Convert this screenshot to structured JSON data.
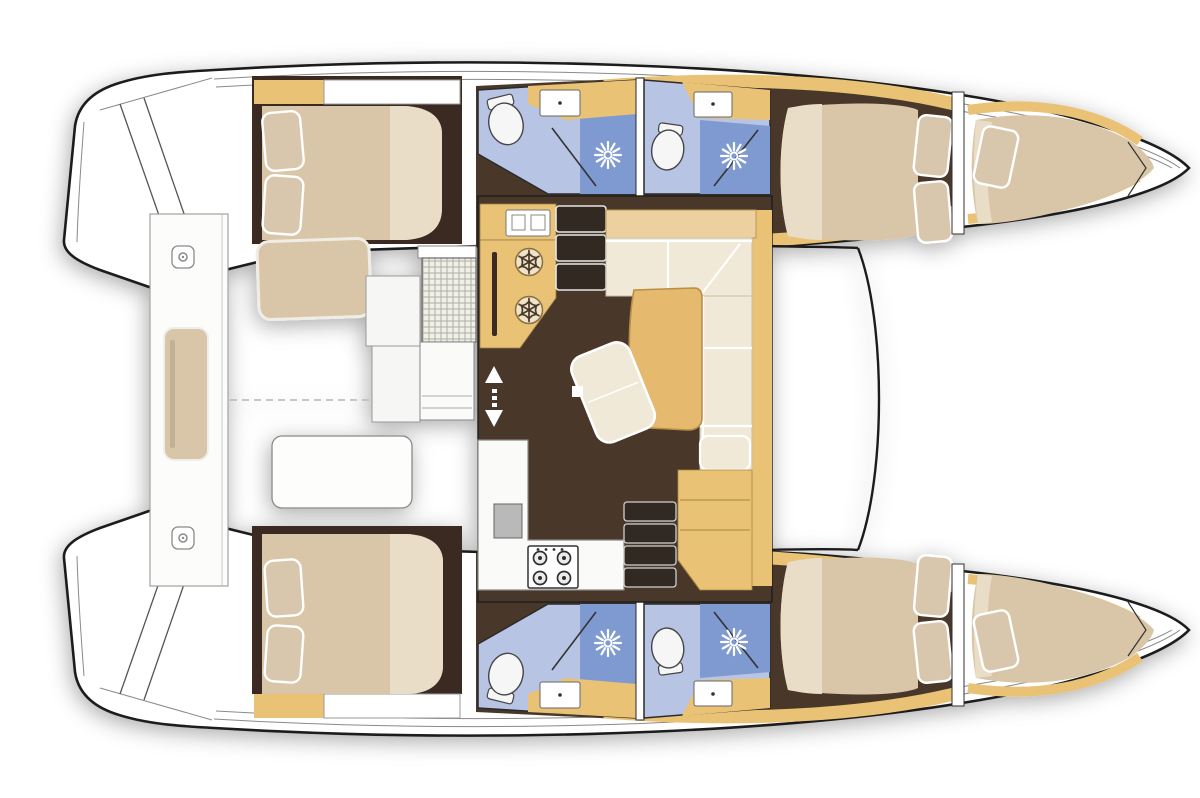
{
  "meta": {
    "label": "Catamaran yacht interior layout - top-down floor plan, bow to the right"
  },
  "palette": {
    "outline": "#1c1c1c",
    "deck_line": "#8a8a8a",
    "hull": "#ffffff",
    "wood": "#e9c276",
    "wood_light": "#ecd0a0",
    "wood_dark": "#b98e44",
    "table": "#e5b96e",
    "floor": "#4a392c",
    "floor_dark": "#3a2c21",
    "mattress": "#d9c6a8",
    "mattress_light": "#e9ddc7",
    "pillow": "#d8c6ad",
    "cushion": "#f1e9d7",
    "bath": "#b7c4e4",
    "bath_mid": "#98acd8",
    "shower": "#7e9ad1",
    "fixture": "#f6f6f6",
    "appliance": "#b9b9b9"
  },
  "vessel": {
    "type": "catamaran",
    "view": "top-down floor plan",
    "orientation": "bow-right",
    "hulls": [
      {
        "name": "top hull",
        "cabins": [
          "aft double cabin",
          "forward double cabin",
          "forepeak berth"
        ],
        "bathrooms": 2
      },
      {
        "name": "bottom hull",
        "cabins": [
          "aft double cabin",
          "forward double cabin",
          "forepeak berth"
        ],
        "bathrooms": 2
      }
    ],
    "bathroom_fixtures": [
      "toilet",
      "sink",
      "shower with rain head"
    ],
    "saloon_features": [
      "L-shaped sofa",
      "dining table",
      "ottoman bench",
      "sofa back shelf",
      "seat module with steps"
    ],
    "galley_features": [
      "sink unit",
      "refrigerator drawer",
      "refrigerator drawer",
      "oven",
      "four-burner stove",
      "counters"
    ],
    "stairs": [
      "top companionway, 3 steps",
      "bottom companionway, 4 steps"
    ],
    "cockpit_features": [
      "side bench with cushion",
      "aft seat with cushion",
      "forward seat",
      "woven cockpit table",
      "storage cabinet",
      "mooring cleats",
      "swim platform steps",
      "dashed centerline"
    ],
    "icons": {
      "snowflake": "refrigerator",
      "sunburst": "shower head",
      "burner-circles": "stove burners",
      "arrows": "companionway up-down"
    }
  }
}
